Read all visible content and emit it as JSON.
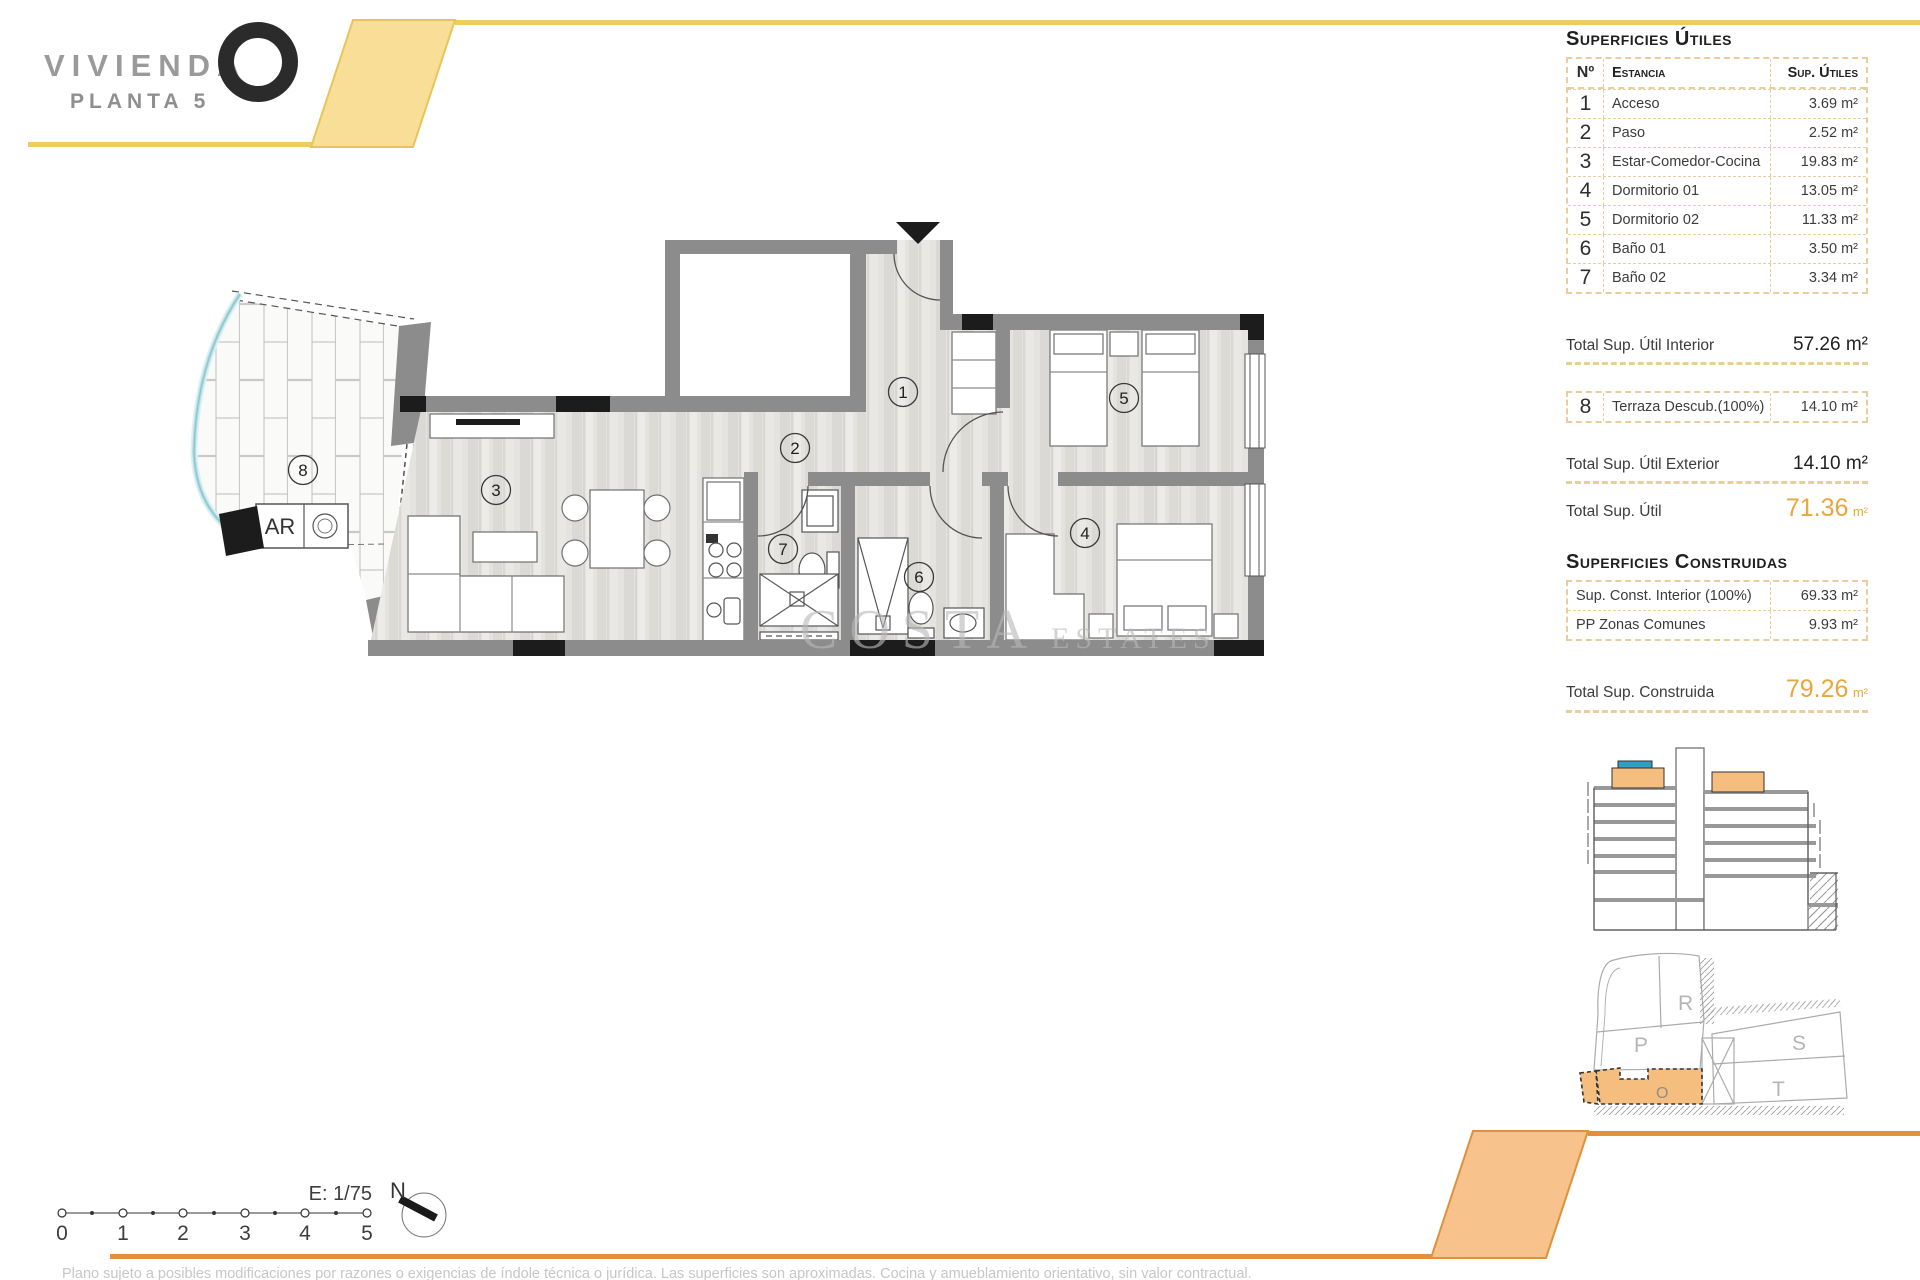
{
  "header": {
    "brand": "VIVIENDA",
    "floor": "PLANTA 5"
  },
  "surfaces_utiles": {
    "title": "Superficies Útiles",
    "columns": {
      "num": "Nº",
      "room": "Estancia",
      "sup": "Sup. Útiles"
    },
    "rows": [
      {
        "num": "1",
        "room": "Acceso",
        "sup": "3.69 m²"
      },
      {
        "num": "2",
        "room": "Paso",
        "sup": "2.52 m²"
      },
      {
        "num": "3",
        "room": "Estar-Comedor-Cocina",
        "sup": "19.83 m²"
      },
      {
        "num": "4",
        "room": "Dormitorio 01",
        "sup": "13.05 m²"
      },
      {
        "num": "5",
        "room": "Dormitorio 02",
        "sup": "11.33 m²"
      },
      {
        "num": "6",
        "room": "Baño 01",
        "sup": "3.50 m²"
      },
      {
        "num": "7",
        "room": "Baño 02",
        "sup": "3.34 m²"
      }
    ],
    "total_interior": {
      "label": "Total Sup. Útil Interior",
      "value": "57.26 m²"
    },
    "terrace_row": {
      "num": "8",
      "room": "Terraza Descub.(100%)",
      "sup": "14.10 m²"
    },
    "total_exterior": {
      "label": "Total Sup. Útil Exterior",
      "value": "14.10 m²"
    },
    "total": {
      "label": "Total Sup. Útil",
      "value": "71.36",
      "unit": "m²"
    }
  },
  "surfaces_construidas": {
    "title": "Superficies Construidas",
    "rows": [
      {
        "room": "Sup. Const. Interior (100%)",
        "sup": "69.33 m²"
      },
      {
        "room": "PP Zonas Comunes",
        "sup": "9.93 m²"
      }
    ],
    "total": {
      "label": "Total Sup. Construida",
      "value": "79.26",
      "unit": "m²"
    }
  },
  "plan": {
    "room_labels": [
      "1",
      "2",
      "3",
      "4",
      "5",
      "6",
      "7",
      "8"
    ],
    "ar_label": "AR",
    "watermark": {
      "part1": "COSTA",
      "part2": "ESTATES"
    }
  },
  "scale_bar": {
    "labels": [
      "0",
      "1",
      "2",
      "3",
      "4",
      "5"
    ],
    "scale_text": "E: 1/75",
    "north": "N"
  },
  "site_plan": {
    "p": "P",
    "r": "R",
    "s": "S",
    "t": "T",
    "o": "O"
  },
  "footer": {
    "disclaimer": "Plano sujeto a posibles modificaciones por razones o exigencias de índole técnica o jurídica. Las superficies son aproximadas. Cocina y amueblamiento orientativo, sin valor contractual."
  },
  "colors": {
    "accent_yellow": "#F0CC60",
    "accent_orange": "#E1903C",
    "table_border": "#E8CD9F",
    "highlight_orange": "#F6BE7E",
    "total_orange": "#E9A63C"
  }
}
